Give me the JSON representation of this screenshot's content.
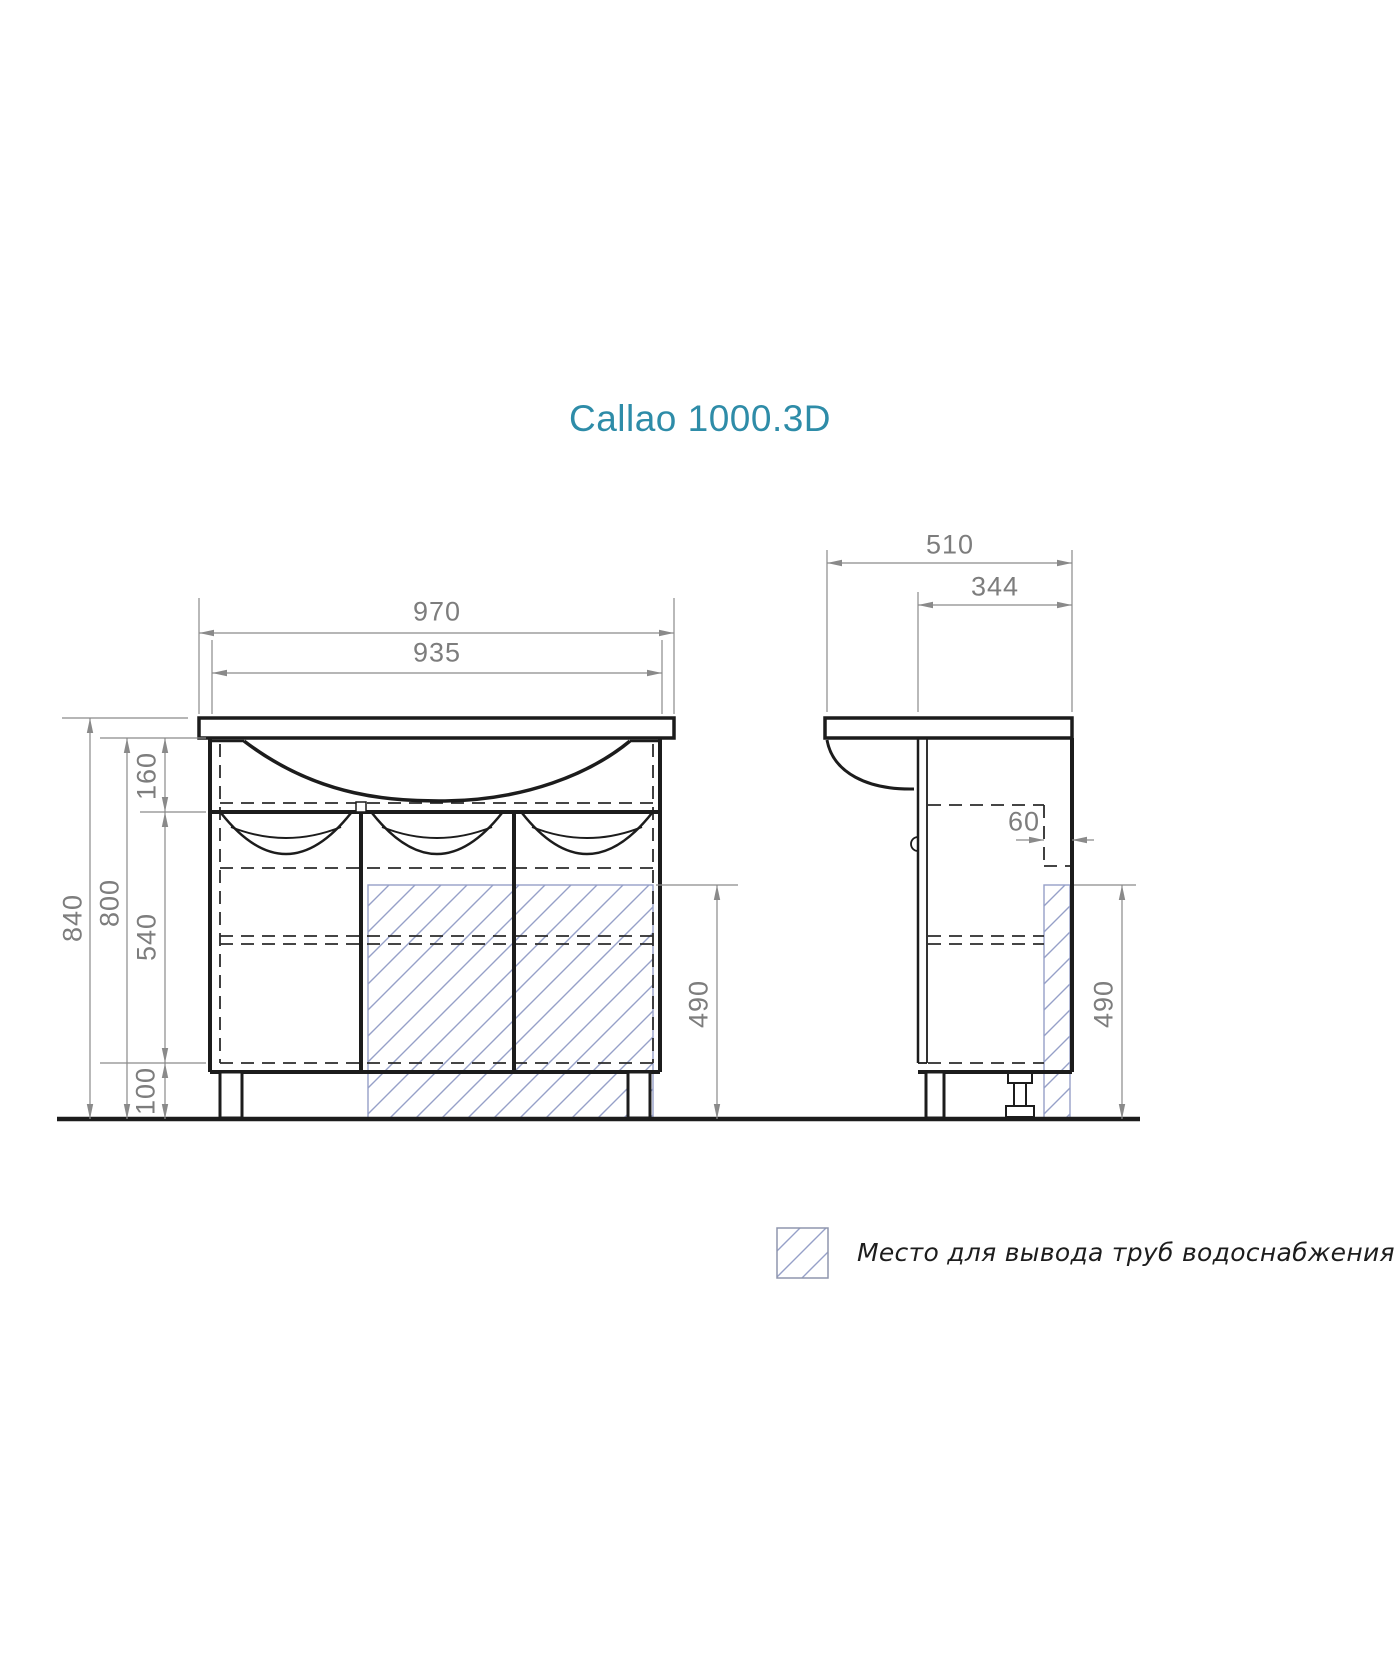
{
  "title": "Callao 1000.3D",
  "colors": {
    "accent": "#2e8ca8",
    "drawing_line": "#1c1c1c",
    "dimension": "#8a8a8a",
    "hatch": "#96a0c8"
  },
  "front_view": {
    "dims": {
      "overall_width": "970",
      "basin_width": "935",
      "total_height": "840",
      "body_height": "800",
      "apron_height": "160",
      "door_height": "540",
      "leg_height": "100",
      "pipe_zone_height": "490"
    }
  },
  "side_view": {
    "dims": {
      "overall_depth": "510",
      "body_depth": "344",
      "pipe_zone_depth": "60",
      "pipe_zone_height": "490"
    }
  },
  "legend": {
    "pipe_zone_label": "Место для вывода труб водоснабжения и канализации"
  }
}
